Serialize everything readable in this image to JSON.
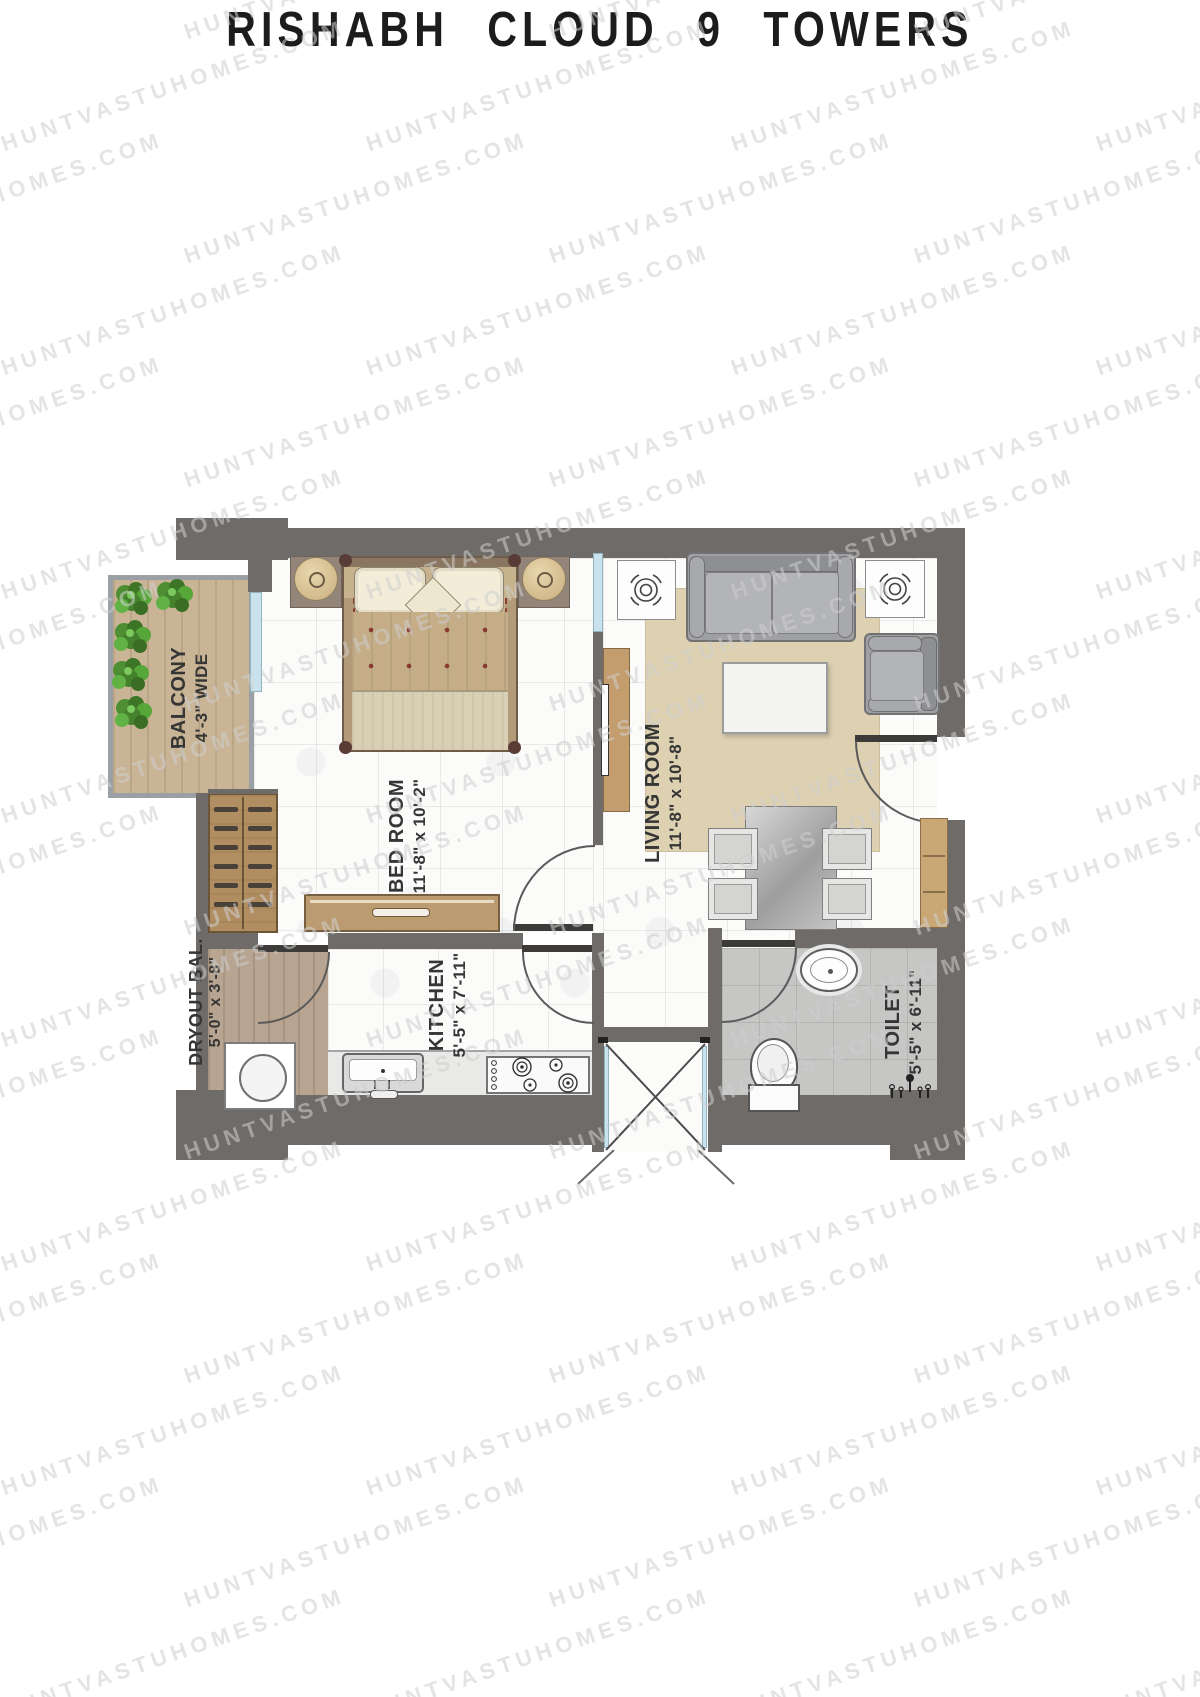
{
  "title": "RISHABH CLOUD 9 TOWERS",
  "watermark": {
    "text": "HUNTVASTUHOMES.COM",
    "color": "#cfcfcf"
  },
  "rooms": {
    "balcony": {
      "name": "BALCONY",
      "dim": "4'-3\" WIDE"
    },
    "bedroom": {
      "name": "BED ROOM",
      "dim": "11'-8\" x 10'-2\""
    },
    "living": {
      "name": "LIVING ROOM",
      "dim": "11'-8\" x 10'-8\""
    },
    "dryout": {
      "name": "DRYOUT BAL.",
      "dim": "5'-0\" x 3'-8\""
    },
    "kitchen": {
      "name": "KITCHEN",
      "dim": "5'-5\" x 7'-11\""
    },
    "toilet": {
      "name": "TOILET",
      "dim": "5'-5\" x 6'-11\""
    }
  },
  "colors": {
    "wall": "#6e6b68",
    "window": "#c9e2ec",
    "wood": "#c9b596",
    "rug": "#ddd1b2",
    "title_text": "#1c1c1c"
  }
}
